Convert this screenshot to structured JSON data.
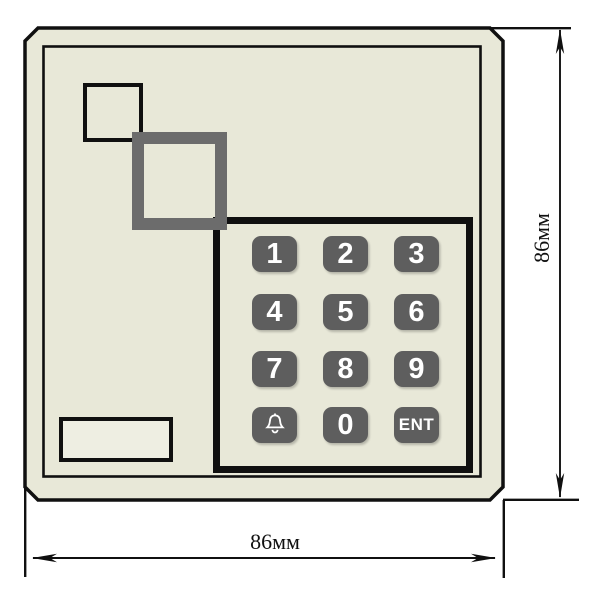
{
  "keypad": {
    "rows": 4,
    "cols": 3,
    "keys": [
      {
        "label": "1"
      },
      {
        "label": "2"
      },
      {
        "label": "3"
      },
      {
        "label": "4"
      },
      {
        "label": "5"
      },
      {
        "label": "6"
      },
      {
        "label": "7"
      },
      {
        "label": "8"
      },
      {
        "label": "9"
      },
      {
        "label": "",
        "icon": "bell"
      },
      {
        "label": "0"
      },
      {
        "label": "ENT"
      }
    ]
  },
  "dimensions": {
    "width_label": "86мм",
    "height_label": "86мм"
  },
  "colors": {
    "background": "#ffffff",
    "body_fill": "#e8e8d8",
    "slot_fill": "#eeeee2",
    "outline": "#101010",
    "key_fill": "#5e5e5e",
    "key_text": "#ffffff",
    "gray_square": "#6c6c6c"
  }
}
